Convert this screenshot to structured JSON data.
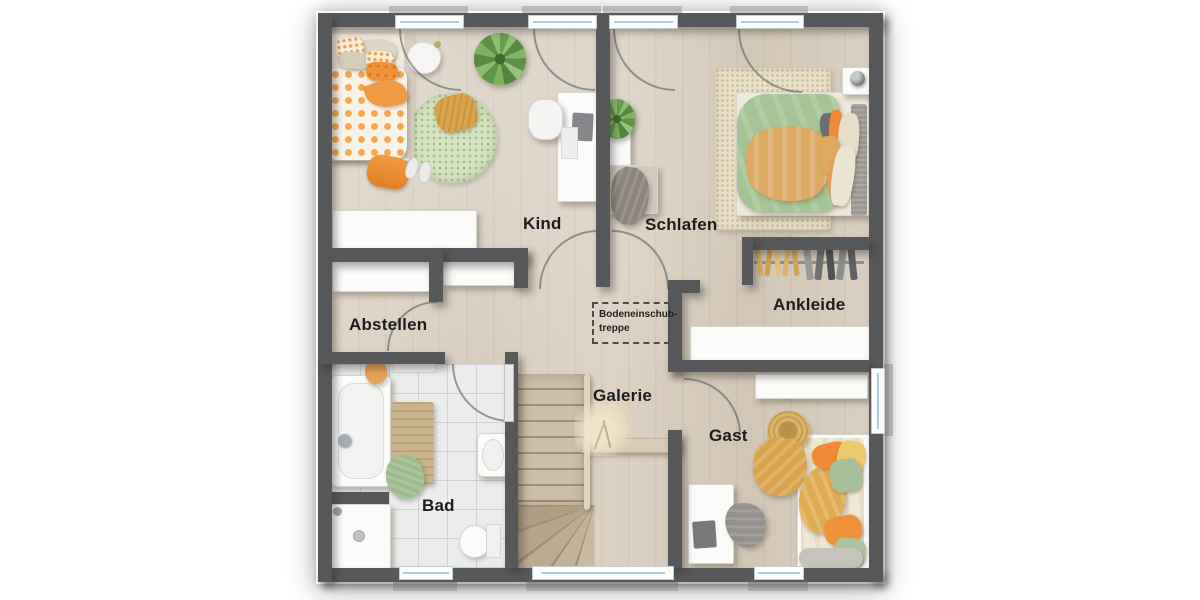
{
  "plan": {
    "rooms": {
      "kind": {
        "label": "Kind"
      },
      "schlafen": {
        "label": "Schlafen"
      },
      "abstellen": {
        "label": "Abstellen"
      },
      "ankleide": {
        "label": "Ankleide"
      },
      "bad": {
        "label": "Bad"
      },
      "galerie": {
        "label": "Galerie"
      },
      "gast": {
        "label": "Gast"
      }
    },
    "annotations": {
      "attic_hatch": {
        "line1": "Bodeneinschub-",
        "line2": "treppe"
      }
    },
    "palette": {
      "wall": "#57585a",
      "floor_wood": "#d8cec0",
      "floor_tile": "#ebecec",
      "window_glass": "#a9cfe3",
      "accent_orange": "#f09a3e",
      "accent_green_duvet": "#a5c596",
      "accent_mustard": "#dca85c",
      "rug_green": "#d5e2c0",
      "stair_wood": "#cec0a9"
    }
  }
}
